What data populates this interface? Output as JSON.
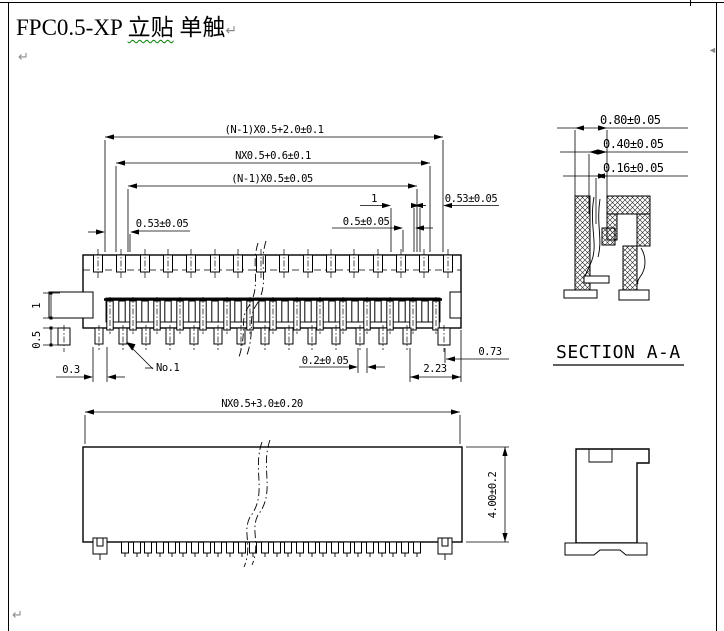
{
  "page": {
    "title_prefix": "FPC0.5-XP ",
    "title_term1": "立贴",
    "title_sep": " ",
    "title_term2": "单触",
    "paragraph_mark": "↵",
    "anchor_mark": "◄"
  },
  "top_view": {
    "dim_overall": "(N-1)X0.5+2.0±0.1",
    "dim_housing": "NX0.5+0.6±0.1",
    "dim_contacts": "(N-1)X0.5±0.05",
    "dim_pitch2": "1",
    "dim_edge_left": "0.53±0.05",
    "dim_edge_right": "0.53±0.05",
    "dim_pitch": "0.5±0.05",
    "dim_pin_width": "0.2±0.05",
    "dim_tail": "2.23",
    "dim_tail_edge": "0.73",
    "label_pin1": "No.1",
    "dim_ear": "1",
    "dim_foot": "0.5",
    "dim_offset": "0.3"
  },
  "section_view": {
    "dim_top": "0.80±0.05",
    "dim_mid": "0.40±0.05",
    "dim_bot": "0.16±0.05",
    "label": "SECTION A-A"
  },
  "front_view": {
    "dim_width": "NX0.5+3.0±0.20",
    "dim_height": "4.00±0.2"
  },
  "colors": {
    "line": "#000000",
    "spellcheck_underline": "#007f00",
    "formatting_marks": "#8a8a8a",
    "background": "#ffffff"
  }
}
